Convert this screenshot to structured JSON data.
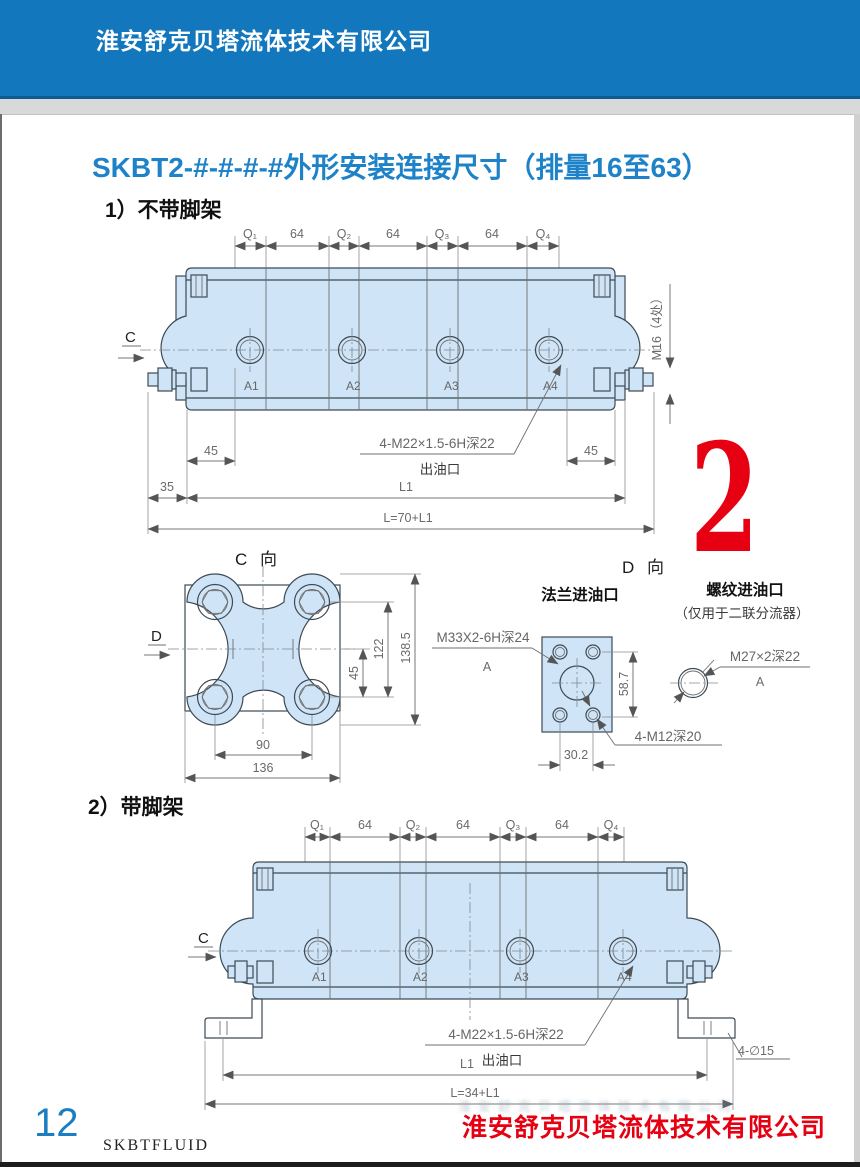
{
  "header": {
    "company": "淮安舒克贝塔流体技术有限公司"
  },
  "title": "SKBT2-#-#-#-#外形安装连接尺寸（排量16至63）",
  "corner_number": "2",
  "s1": {
    "heading": "1）不带脚架",
    "dims_top": [
      "Q₁",
      "64",
      "Q₂",
      "64",
      "Q₃",
      "64",
      "Q₄"
    ],
    "ports": [
      "A1",
      "A2",
      "A3",
      "A4"
    ],
    "view_arrow": "C",
    "stud_spec": "M16（4处）",
    "d45l": "45",
    "d45r": "45",
    "outlet_spec": "4-M22×1.5-6H深22",
    "outlet_label": "出油口",
    "d35": "35",
    "dl1": "L1",
    "dtotal": "L=70+L1"
  },
  "vc": {
    "title": "C 向",
    "view_arrow": "D",
    "d45": "45",
    "d122": "122",
    "d1385": "138.5",
    "d90": "90",
    "d136": "136"
  },
  "vd": {
    "title": "D 向",
    "flange_title": "法兰进油口",
    "thread_title": "螺纹进油口",
    "thread_note": "（仅用于二联分流器）",
    "flange_spec": "M33X2-6H深24",
    "flange_ref": "A",
    "d587": "58.7",
    "bolt_spec": "4-M12深20",
    "d302": "30.2",
    "thread_spec": "M27×2深22",
    "thread_ref": "A"
  },
  "s2": {
    "heading": "2）带脚架",
    "dims_top": [
      "Q₁",
      "64",
      "Q₂",
      "64",
      "Q₃",
      "64",
      "Q₄"
    ],
    "ports": [
      "A1",
      "A2",
      "A3",
      "A4"
    ],
    "view_arrow": "C",
    "outlet_spec": "4-M22×1.5-6H深22",
    "outlet_label": "出油口",
    "foot_holes": "4-∅15",
    "dl1": "L1",
    "dtotal": "L=34+L1"
  },
  "footer": {
    "page_number": "12",
    "brand": "SKBTFLUID",
    "company": "淮安舒克贝塔流体技术有限公司"
  },
  "colors": {
    "header_blue": "#1377bd",
    "title_blue": "#1e82c8",
    "accent_red": "#e60012",
    "body_fill": "#cfe4f6",
    "line": "#3c4a55",
    "dim_gray": "#6a6a6a"
  }
}
